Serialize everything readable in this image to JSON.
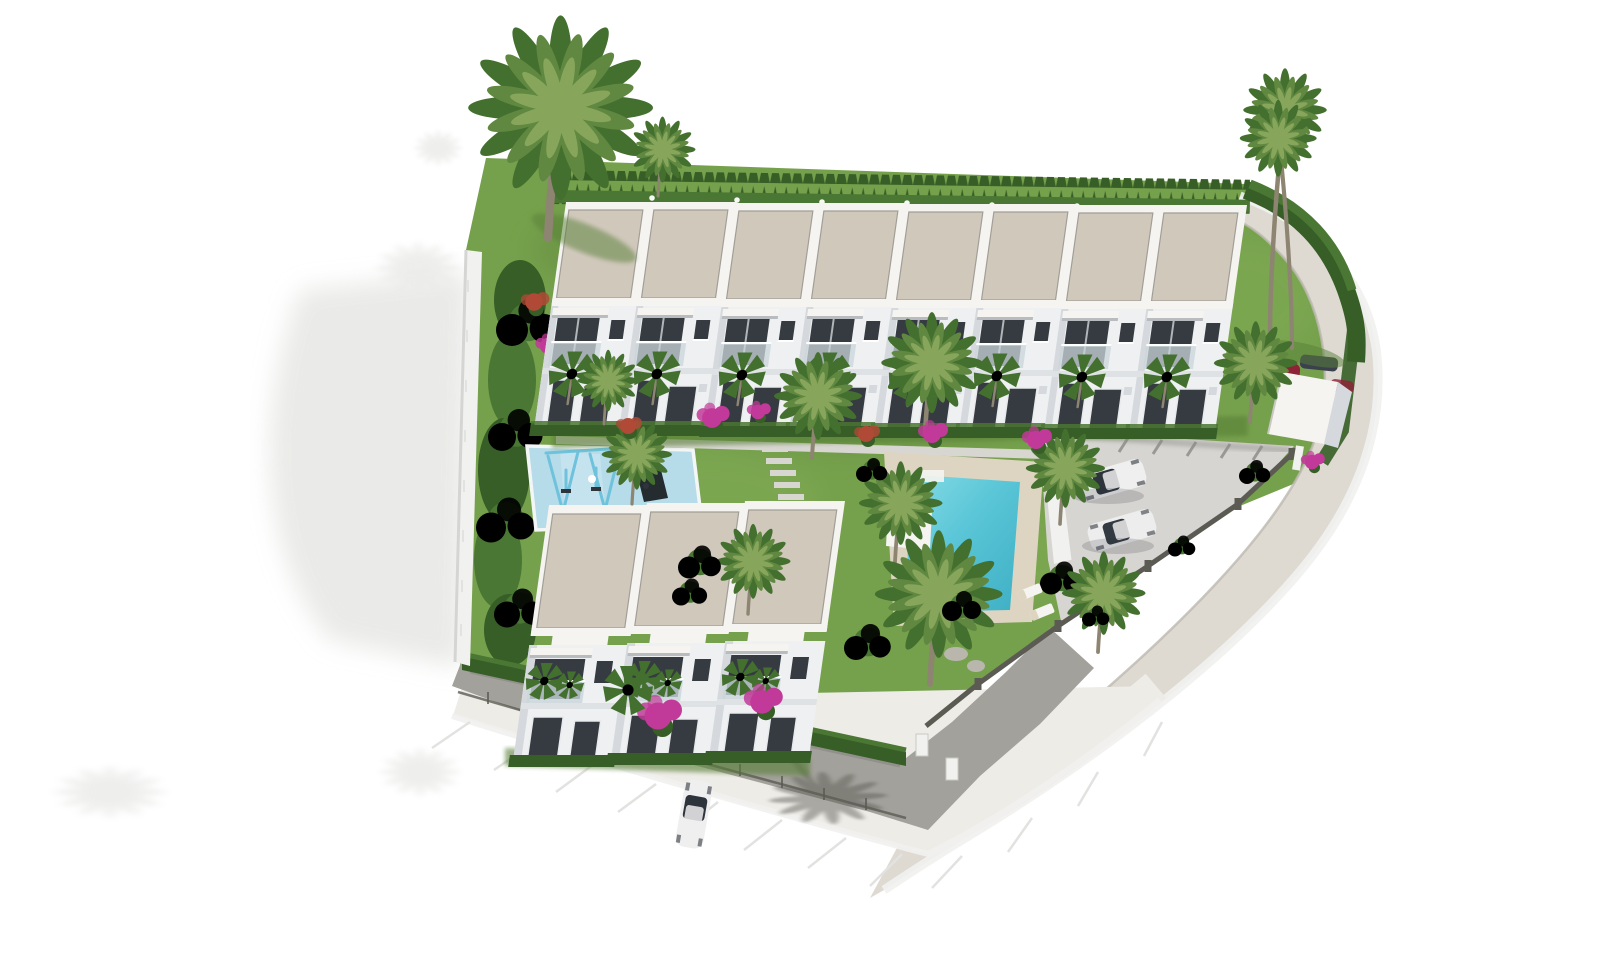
{
  "meta": {
    "title": "Aerial 3D render - white townhouse development with pool and gardens",
    "alt": "Bird's-eye 3D architectural visualisation of a gated residential complex: a row of eight white two-storey townhouses with flat beige roofs at the top, a lower block of three townhouses, a turquoise swimming pool with sun deck and loungers, a children's playground with swings on a blue soft surface, lawns, conifer perimeter hedges, palm trees, pink bougainvillea, a small parking area with two cars, an entrance canopy and a curved street wrapping the right and bottom edges on a white background"
  },
  "scene": {
    "type": "architectural-render-site-plan",
    "buildings": {
      "top_row_units": 8,
      "lower_block_units": 3,
      "storeys": 2,
      "roof_style": "flat gravel roof with white parapet",
      "facade_color_name": "white",
      "features": [
        "recessed balconies with glass balustrades",
        "dark glazed doors and windows",
        "front hedges",
        "fan palms at each entrance"
      ]
    },
    "amenities": {
      "swimming_pools": 1,
      "pool_description": "rectangular turquoise pool with cream sun deck, white corner steps and parasol",
      "sun_loungers": 2,
      "playgrounds": 1,
      "playground_description": "light-blue soft-surface play area with swing frame and small palm"
    },
    "vehicles": {
      "parking_cars": 2,
      "entrance_cars": 2,
      "driveway_cars": 1
    },
    "landscape": {
      "perimeter": "white boundary wall with dark metal fence along the street",
      "hedges": "tall conifer hedge along the top and curving down the right side",
      "palm_trees_approx": 15,
      "flowers": [
        "pink bougainvillea",
        "red shrubs"
      ],
      "street": "curved grey street wrapping the right side and bottom with white kerb and expansion joints",
      "shadows": "soft palm shadows cast on the white ground at the left and bottom"
    }
  },
  "palette": {
    "bg": "#ffffff",
    "shadow": "#d9d9d6",
    "driveShadow": "#56564f",
    "poolShadow": "#1a5d6b",
    "grass": "#76a14c",
    "grassL": "#8db55e",
    "grassD": "#587f38",
    "hedge": "#4a7733",
    "hedgeD": "#365e26",
    "roof": "#d0c8bb",
    "roofE": "#f5f4f1",
    "roofLine": "#a19e97",
    "facade": "#eef0f2",
    "facadeS": "#d5d9dd",
    "glass": "#353b41",
    "rail": "#c9d6da",
    "pool": "#5ac6d7",
    "poolD": "#3fafc4",
    "deck": "#ddd5c1",
    "mat": "#b6dbe9",
    "equip": "#6fc2dc",
    "street": "#dedad2",
    "parking": "#d7d5d1",
    "drive": "#a3a19b",
    "slope": "#eeece7",
    "wall": "#f1f1ef",
    "wallS": "#c9c9c6",
    "fence": "#5b5b54",
    "tick": "#e2e2e0",
    "trunk": "#8d8471",
    "palm": "#618841",
    "palmD": "#44702f",
    "palmL": "#87a65c",
    "pink": "#c23a99",
    "red": "#b04a36",
    "carW": "#efefef",
    "carG": "#2e343c",
    "carR": "#8f2236",
    "carD": "#3a414c",
    "stone": "#b9b6ae"
  }
}
